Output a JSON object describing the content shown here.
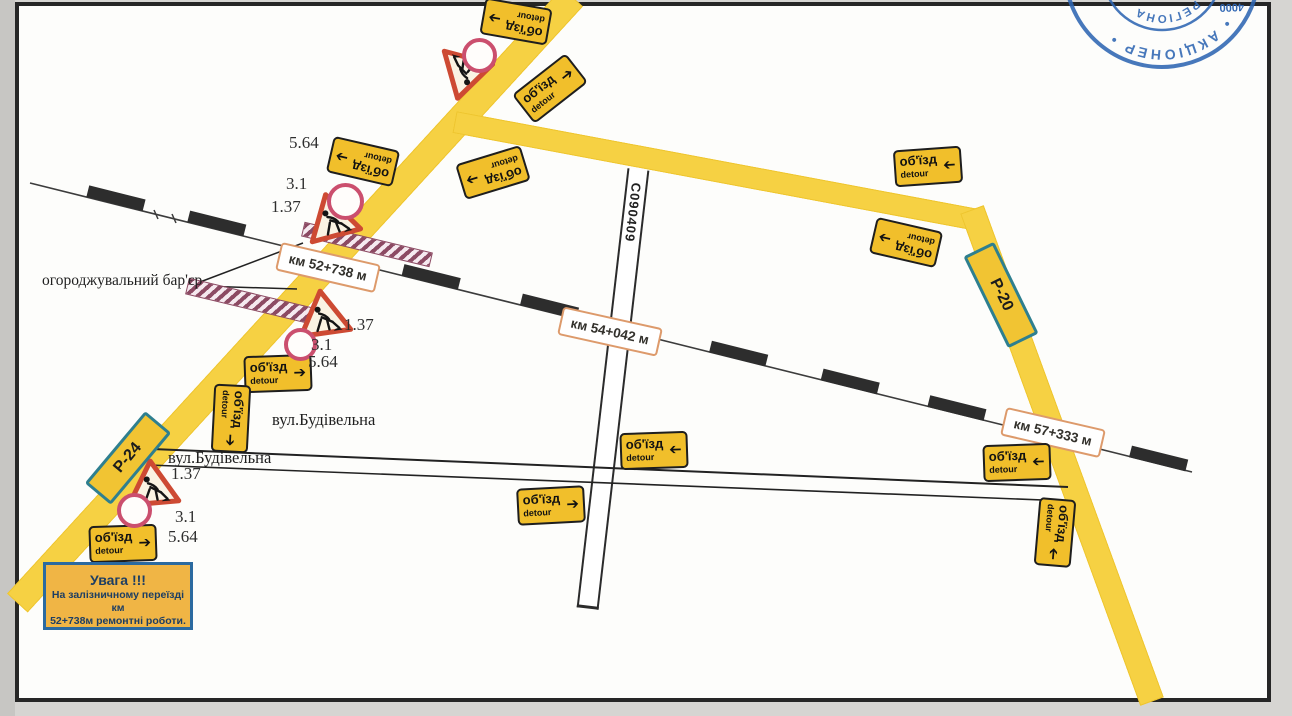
{
  "signs": {
    "detour": {
      "line1": "об'їзд",
      "line2": "detour"
    }
  },
  "icons": {
    "arrow": "➔"
  },
  "km_markers": {
    "km1": "км 52+738 м",
    "km2": "км 54+042 м",
    "km3": "км 57+333 м"
  },
  "road_labels": {
    "p24": "Р-24",
    "p20": "Р-20",
    "c_road": "С090409"
  },
  "street": {
    "name": "вул.Будівельна"
  },
  "annotations": {
    "barrier": "огороджувальний бар'єр",
    "n564": "5.64",
    "n31": "3.1",
    "n137": "1.37"
  },
  "warning": {
    "title": "Увага !!!",
    "line1": "На залізничному переїзді км",
    "line2": "52+738м ремонтні роботи."
  },
  "stamp": {
    "arc_outer": "• АКЦІОНЕР •",
    "arc_inner": "РЕГІОНА",
    "number": "4000"
  },
  "colors": {
    "road_yellow": "#f6d143",
    "sign_yellow": "#f1bf2b",
    "triangle_red": "#cd4a33",
    "circle_red": "#cb4f6e",
    "stamp_blue": "#2f66b3",
    "km_border": "#dd9a6b",
    "warning_border": "#2b6aa0",
    "hatch_purple": "#8c4a63"
  }
}
